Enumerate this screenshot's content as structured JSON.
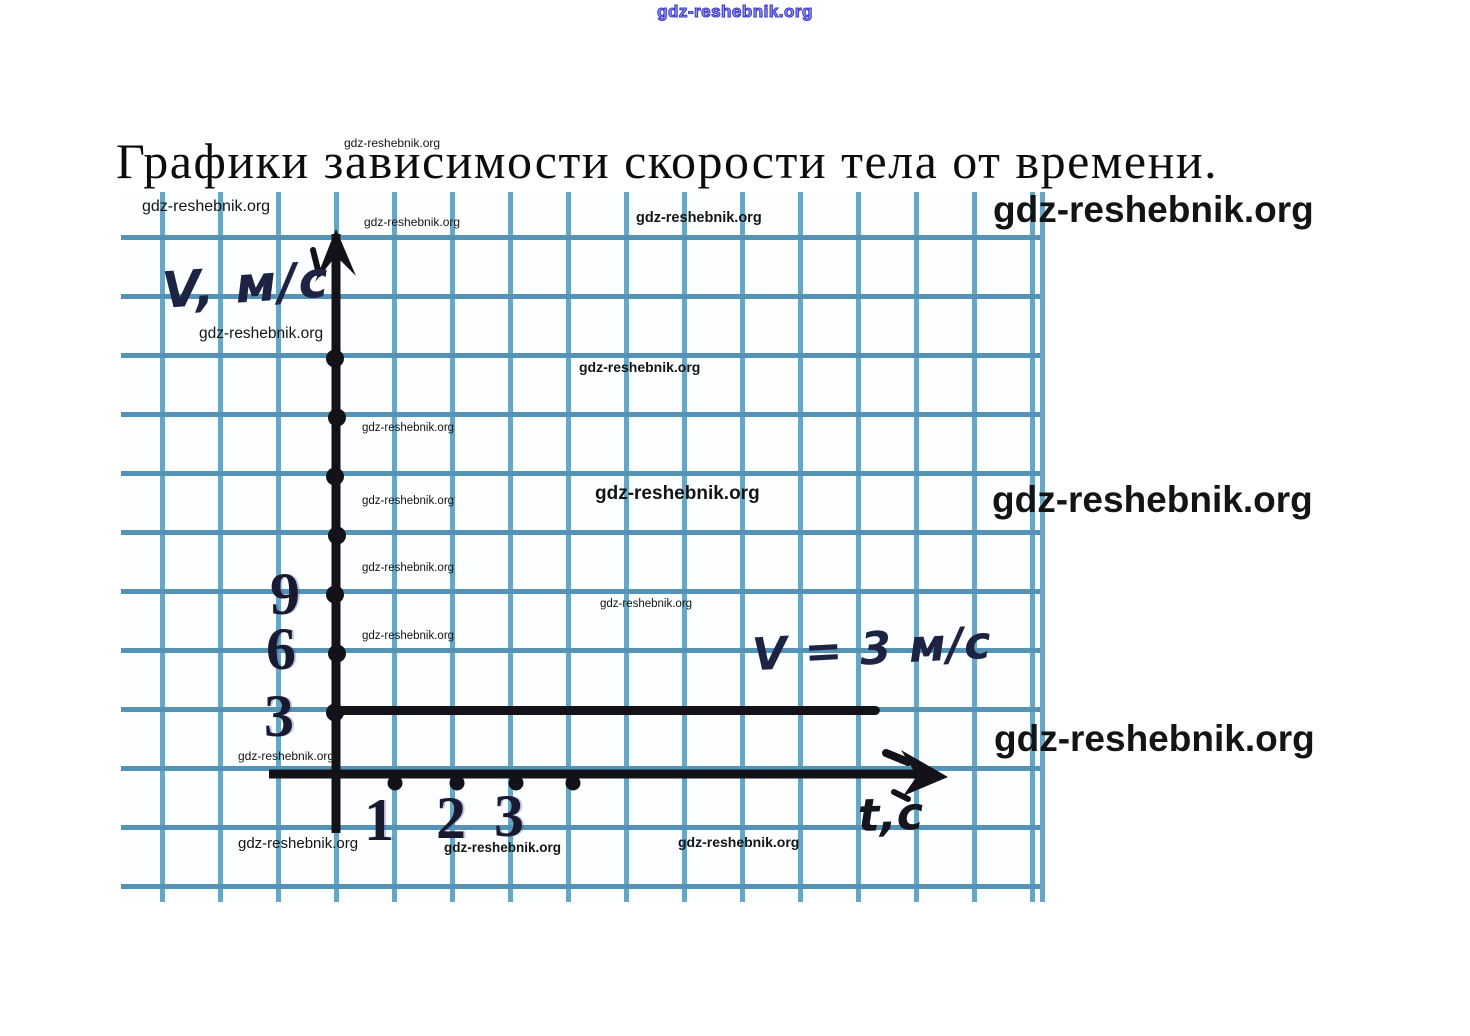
{
  "watermark": {
    "text": "gdz-reshebnik.org"
  },
  "colors": {
    "ink": "#121218",
    "grid_line_horizontal": "#5593b6",
    "grid_line_vertical": "#69a6c6",
    "paper_background": "#fcfeff",
    "top_watermark_blue": "#3c3cce",
    "handwriting": "#1d2342",
    "tick_digit": "#191a2f"
  },
  "chart_data": {
    "type": "line",
    "title": "Графики зависимости скорости тела от времени.",
    "xlabel": "t,c",
    "ylabel": "V, м/с",
    "annotation": "V = 3 м/с",
    "x_tick_labels": [
      "1",
      "2",
      "3"
    ],
    "y_tick_labels": [
      "3",
      "6",
      "9"
    ],
    "x_axis_dots": [
      1,
      2,
      3,
      4
    ],
    "y_axis_dots": [
      3,
      6,
      9,
      12,
      15,
      18,
      21
    ],
    "series": [
      {
        "name": "V = 3 м/с",
        "value": 3,
        "x_start": 0,
        "x_end": 9.3
      }
    ],
    "xlim": [
      0,
      10.5
    ],
    "ylim": [
      0,
      27
    ],
    "grid": true,
    "units_per_cell_x": 1,
    "units_per_cell_y": 3
  }
}
